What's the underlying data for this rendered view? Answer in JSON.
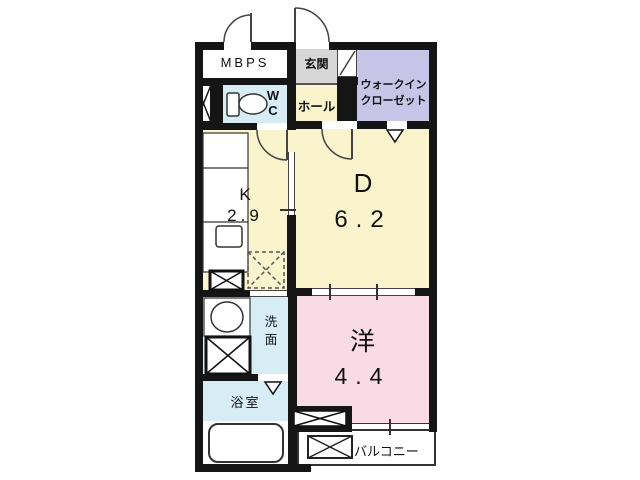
{
  "title": "1DK apartment floor plan",
  "rooms": {
    "mbps": {
      "label": "MBPS"
    },
    "entrance": {
      "label": "玄関"
    },
    "walk_in_closet": {
      "label_line1": "ウォークイン",
      "label_line2": "クローゼット"
    },
    "hall": {
      "label": "ホール"
    },
    "toilet": {
      "label_line1": "W",
      "label_line2": "C"
    },
    "kitchen": {
      "label": "K",
      "size": "2.9"
    },
    "dining": {
      "label": "D",
      "size": "6.2"
    },
    "washroom": {
      "label_line1": "洗",
      "label_line2": "面"
    },
    "bathroom": {
      "label": "浴室"
    },
    "western_room": {
      "label": "洋",
      "size": "4.4"
    },
    "balcony": {
      "label": "バルコニー"
    }
  },
  "colors": {
    "wall": "#151515",
    "room_yellow": "#faf4cc",
    "room_pink": "#f9dbe5",
    "room_blue": "#d7edf5",
    "room_purple": "#c6c5e8",
    "room_gray": "#d7d7d7",
    "line": "#333333"
  }
}
